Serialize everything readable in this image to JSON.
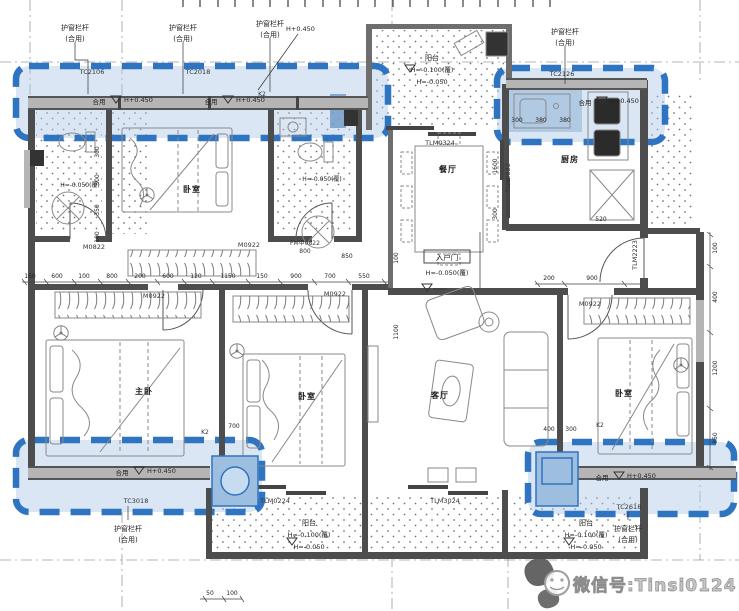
{
  "watermark": {
    "text": "微信号:Tinsi0124",
    "icon": "wechat-face-icon"
  },
  "colors": {
    "highlight_border": "#2f74c0",
    "highlight_fill": "#adc8e6",
    "wall": "#4d4d4d",
    "watermark_gray": "#9f9f9f"
  },
  "rooms": {
    "dining": "餐厅",
    "kitchen": "厨房",
    "living": "客厅",
    "master_bedroom": "主卧",
    "bedroom_top": "卧室",
    "bedroom_mid": "卧室",
    "bedroom_right": "卧室",
    "balcony_top": "阳台",
    "balcony_left": "阳台",
    "balcony_right": "阳台"
  },
  "railing": {
    "line1": "护窗栏杆",
    "line2": "(合用)"
  },
  "shared": "合用",
  "levels": {
    "plus": "H+0.450",
    "minus100": "H=-0.100(覆)",
    "minus050": "H=-0.050",
    "minus050f": "H=-0.050(覆)"
  },
  "entry": {
    "label": "入户门",
    "level": "H=-0.050(覆)"
  },
  "codes": {
    "m0922": "M0922",
    "m0822": "M0822",
    "fm": "FM甲0822",
    "fm_w": "800",
    "tlm0324": "TLM0324",
    "tlm0224": "TLM0224",
    "tlm3024": "TLM3024",
    "tlm0822": "TLM0822",
    "tlm2223": "TLM2223",
    "tc_a": "TC2106",
    "tc_b": "TC2018",
    "tc_c": "TC2126",
    "tc_d": "TC3018",
    "tc_e": "TC2618",
    "k2": "K2"
  },
  "dims": {
    "row_mid": [
      "150",
      "600",
      "100",
      "800",
      "200",
      "600",
      "120",
      "1150",
      "150",
      "900",
      "700",
      "550"
    ],
    "row_right": [
      "200",
      "900"
    ],
    "col_right": [
      "100",
      "400",
      "1200",
      "850"
    ],
    "col_bath": [
      "300",
      "300",
      "350",
      "100"
    ],
    "kitchen": [
      "1600",
      "300",
      "520"
    ],
    "top_right": [
      "300",
      "380",
      "380"
    ],
    "misc": [
      "700",
      "400",
      "300",
      "1100",
      "100",
      "50",
      "100",
      "850"
    ]
  }
}
